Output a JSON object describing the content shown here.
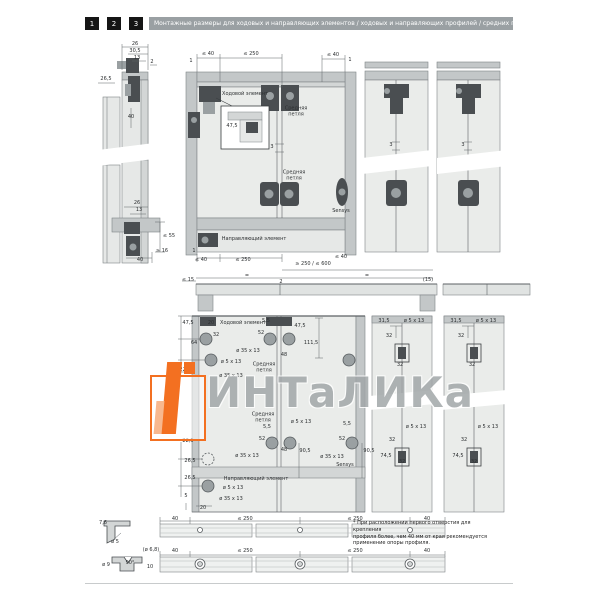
{
  "header": {
    "tabs": [
      "1",
      "2",
      "3"
    ],
    "title": "Монтажные размеры для ходовых и направляющих элементов / ходовых и направляющих профилей / средних петель"
  },
  "colors": {
    "accent_orange": "#f37021",
    "header_gray": "#9aa0a3",
    "panel_light": "#eaecea",
    "rail_gray": "#c3c7c8",
    "fitting_dark": "#4a4e51"
  },
  "watermark": {
    "text": "ИНТаЛИКа"
  },
  "footnote": "* При расположении первого отверстия для крепления\nпрофиля более, чем 40 мм от края рекомендуется\nприменение опоры профиля.",
  "annotations": [
    {
      "t": "26",
      "x": 135,
      "y": 45
    },
    {
      "t": "30,5",
      "x": 135,
      "y": 52
    },
    {
      "t": "13",
      "x": 137,
      "y": 59
    },
    {
      "t": "2",
      "x": 152,
      "y": 63
    },
    {
      "t": "26,5",
      "x": 106,
      "y": 80
    },
    {
      "t": "40",
      "x": 131,
      "y": 118
    },
    {
      "t": "26",
      "x": 137,
      "y": 204
    },
    {
      "t": "13",
      "x": 139,
      "y": 211
    },
    {
      "t": "≤ 55",
      "x": 169,
      "y": 237
    },
    {
      "t": "≥ 16",
      "x": 162,
      "y": 252
    },
    {
      "t": "40",
      "x": 140,
      "y": 261
    },
    {
      "t": "1",
      "x": 191,
      "y": 62
    },
    {
      "t": "≤ 40",
      "x": 208,
      "y": 55
    },
    {
      "t": "≤ 250",
      "x": 251,
      "y": 55
    },
    {
      "t": "≤ 40",
      "x": 333,
      "y": 56
    },
    {
      "t": "1",
      "x": 350,
      "y": 61
    },
    {
      "t": "Ходовой элемент",
      "x": 245,
      "y": 95,
      "n": "component-label"
    },
    {
      "t": "Средняя\nпетля",
      "x": 296,
      "y": 112,
      "n": "component-label"
    },
    {
      "t": "47,5",
      "x": 232,
      "y": 127
    },
    {
      "t": "Средняя\nпетля",
      "x": 294,
      "y": 176,
      "n": "component-label"
    },
    {
      "t": "Sensys",
      "x": 341,
      "y": 212,
      "n": "component-label"
    },
    {
      "t": "3",
      "x": 272,
      "y": 148
    },
    {
      "t": "Направляющий элемент",
      "x": 254,
      "y": 240,
      "n": "component-label"
    },
    {
      "t": "1",
      "x": 194,
      "y": 252
    },
    {
      "t": "≤ 40",
      "x": 201,
      "y": 261
    },
    {
      "t": "≤ 250",
      "x": 243,
      "y": 261
    },
    {
      "t": "≤ 40",
      "x": 341,
      "y": 258
    },
    {
      "t": "≥ 250 / ≤ 600",
      "x": 313,
      "y": 265
    },
    {
      "t": "≤ 15",
      "x": 188,
      "y": 281
    },
    {
      "t": "=",
      "x": 247,
      "y": 277
    },
    {
      "t": "2",
      "x": 281,
      "y": 283
    },
    {
      "t": "=",
      "x": 367,
      "y": 277
    },
    {
      "t": "(15)",
      "x": 428,
      "y": 281
    },
    {
      "t": "3",
      "x": 391,
      "y": 146
    },
    {
      "t": "3",
      "x": 463,
      "y": 146
    },
    {
      "t": "47,5",
      "x": 188,
      "y": 324
    },
    {
      "t": "20",
      "x": 211,
      "y": 324
    },
    {
      "t": "Ходовой элемент",
      "x": 243,
      "y": 324,
      "n": "component-label"
    },
    {
      "t": "5,5",
      "x": 266,
      "y": 322
    },
    {
      "t": "52",
      "x": 261,
      "y": 334
    },
    {
      "t": "47,5",
      "x": 300,
      "y": 327
    },
    {
      "t": "64",
      "x": 194,
      "y": 344
    },
    {
      "t": "32",
      "x": 216,
      "y": 336
    },
    {
      "t": "ø 35 x 13",
      "x": 248,
      "y": 352
    },
    {
      "t": "48",
      "x": 284,
      "y": 356
    },
    {
      "t": "ø 5 x 13",
      "x": 231,
      "y": 363
    },
    {
      "t": "Средняя\nпетля",
      "x": 264,
      "y": 368,
      "n": "component-label"
    },
    {
      "t": "ø 35 x 13",
      "x": 231,
      "y": 377
    },
    {
      "t": "22,5",
      "x": 185,
      "y": 371
    },
    {
      "t": "111,5",
      "x": 311,
      "y": 344
    },
    {
      "t": "31,5",
      "x": 384,
      "y": 322
    },
    {
      "t": "ø 5 x 13",
      "x": 414,
      "y": 322
    },
    {
      "t": "32",
      "x": 389,
      "y": 337
    },
    {
      "t": "32",
      "x": 400,
      "y": 366
    },
    {
      "t": "31,5",
      "x": 456,
      "y": 322
    },
    {
      "t": "ø 5 x 13",
      "x": 486,
      "y": 322
    },
    {
      "t": "32",
      "x": 461,
      "y": 337
    },
    {
      "t": "32",
      "x": 472,
      "y": 366
    },
    {
      "t": "Средняя\nпетля",
      "x": 263,
      "y": 418,
      "n": "component-label"
    },
    {
      "t": "ø 5 x 13",
      "x": 301,
      "y": 423
    },
    {
      "t": "5,5",
      "x": 267,
      "y": 428
    },
    {
      "t": "52",
      "x": 262,
      "y": 440
    },
    {
      "t": "ø 35 x 13",
      "x": 247,
      "y": 457
    },
    {
      "t": "48",
      "x": 284,
      "y": 451
    },
    {
      "t": "90,5",
      "x": 305,
      "y": 452
    },
    {
      "t": "22,5",
      "x": 188,
      "y": 442
    },
    {
      "t": "26,5",
      "x": 190,
      "y": 462
    },
    {
      "t": "26,5",
      "x": 190,
      "y": 479
    },
    {
      "t": "Направляющий элемент",
      "x": 256,
      "y": 480,
      "n": "component-label"
    },
    {
      "t": "ø 5 x 13",
      "x": 233,
      "y": 489
    },
    {
      "t": "ø 35 x 13",
      "x": 231,
      "y": 500
    },
    {
      "t": "5",
      "x": 186,
      "y": 497
    },
    {
      "t": "20",
      "x": 203,
      "y": 509
    },
    {
      "t": "5,5",
      "x": 347,
      "y": 425
    },
    {
      "t": "52",
      "x": 342,
      "y": 440
    },
    {
      "t": "ø 35 x 13",
      "x": 332,
      "y": 458
    },
    {
      "t": "Sensys",
      "x": 345,
      "y": 466,
      "n": "component-label"
    },
    {
      "t": "90,5",
      "x": 369,
      "y": 452
    },
    {
      "t": "32",
      "x": 392,
      "y": 441
    },
    {
      "t": "74,5",
      "x": 386,
      "y": 457
    },
    {
      "t": "32",
      "x": 402,
      "y": 463
    },
    {
      "t": "ø 5 x 13",
      "x": 416,
      "y": 428
    },
    {
      "t": "32",
      "x": 464,
      "y": 441
    },
    {
      "t": "74,5",
      "x": 458,
      "y": 457
    },
    {
      "t": "32",
      "x": 474,
      "y": 463
    },
    {
      "t": "ø 5 x 13",
      "x": 488,
      "y": 428
    },
    {
      "t": "7,6",
      "x": 103,
      "y": 524
    },
    {
      "t": "ø 5",
      "x": 115,
      "y": 543
    },
    {
      "t": "40",
      "x": 175,
      "y": 520
    },
    {
      "t": "≤ 250",
      "x": 245,
      "y": 520
    },
    {
      "t": "≤ 250",
      "x": 355,
      "y": 520
    },
    {
      "t": "40",
      "x": 427,
      "y": 520
    },
    {
      "t": "(ø 6,8)",
      "x": 151,
      "y": 551
    },
    {
      "t": "ø 9",
      "x": 106,
      "y": 566
    },
    {
      "t": "90°",
      "x": 130,
      "y": 564
    },
    {
      "t": "10",
      "x": 150,
      "y": 568
    },
    {
      "t": "40",
      "x": 175,
      "y": 552
    },
    {
      "t": "≤ 250",
      "x": 245,
      "y": 552
    },
    {
      "t": "≤ 250",
      "x": 355,
      "y": 552
    },
    {
      "t": "40",
      "x": 427,
      "y": 552
    }
  ]
}
